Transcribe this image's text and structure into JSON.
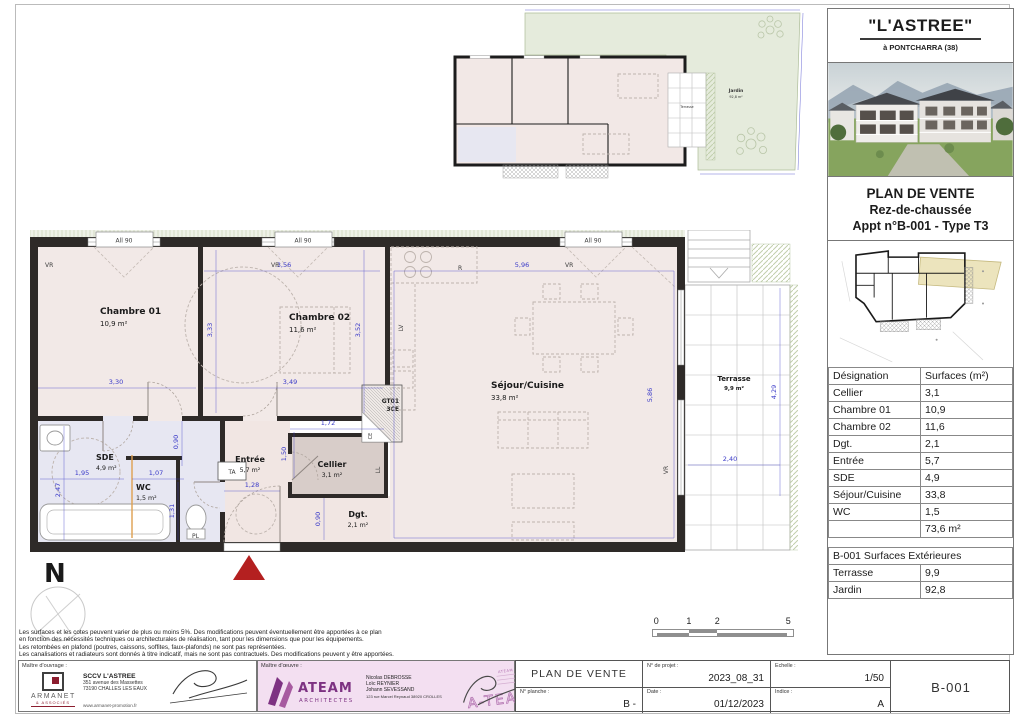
{
  "colors": {
    "dimension_blue": "#3a3ac8",
    "wall_black": "#2e2a28",
    "room_pink": "#f2e9e7",
    "wet_room_lavender": "#e7e7f2",
    "garden_green": "#e5ebdc",
    "highlight_yellow": "#ece4bd",
    "armanet_red": "#8c1d2f",
    "ateam_purple": "#7d3282",
    "entrance_triangle_red": "#b42020"
  },
  "project": {
    "name": "\"L'ASTREE\"",
    "location": "à PONTCHARRA (38)",
    "plan_type": "PLAN DE VENTE",
    "floor": "Rez-de-chaussée",
    "apartment": "Appt n°B-001 - Type T3"
  },
  "surfaces_table": {
    "headers": {
      "designation": "Désignation",
      "surface": "Surfaces (m²)"
    },
    "rows": [
      {
        "designation": "Cellier",
        "surface": "3,1"
      },
      {
        "designation": "Chambre 01",
        "surface": "10,9"
      },
      {
        "designation": "Chambre 02",
        "surface": "11,6"
      },
      {
        "designation": "Dgt.",
        "surface": "2,1"
      },
      {
        "designation": "Entrée",
        "surface": "5,7"
      },
      {
        "designation": "SDE",
        "surface": "4,9"
      },
      {
        "designation": "Séjour/Cuisine",
        "surface": "33,8"
      },
      {
        "designation": "WC",
        "surface": "1,5"
      }
    ],
    "total": "73,6 m²"
  },
  "exterior_table": {
    "title": "B-001 Surfaces Extérieures",
    "rows": [
      {
        "designation": "Terrasse",
        "surface": "9,9"
      },
      {
        "designation": "Jardin",
        "surface": "92,8"
      }
    ]
  },
  "floor_plan": {
    "rooms": {
      "chambre01": {
        "name": "Chambre 01",
        "area": "10,9 m²"
      },
      "chambre02": {
        "name": "Chambre 02",
        "area": "11,6 m²"
      },
      "sejour": {
        "name": "Séjour/Cuisine",
        "area": "33,8 m²"
      },
      "sde": {
        "name": "SDE",
        "area": "4,9 m²"
      },
      "wc": {
        "name": "WC",
        "area": "1,5 m²"
      },
      "entree": {
        "name": "Entrée",
        "area": "5,7 m²"
      },
      "cellier": {
        "name": "Cellier",
        "area": "3,1 m²"
      },
      "dgt": {
        "name": "Dgt.",
        "area": "2,1 m²"
      },
      "terrasse": {
        "name": "Terrasse",
        "area": "9,9 m²"
      }
    },
    "dimensions": {
      "ch01_width": "3,30",
      "ch02_width": "3,49",
      "ch01_height": "3,33",
      "ch02_height": "3,52",
      "ch02_top": "3,56",
      "sejour_width": "5,96",
      "sejour_height": "5,86",
      "cellier_width": "1,72",
      "cellier_height": "1,50",
      "entree_width": "1,28",
      "hall_height": "0,90",
      "sde_width": "1,95",
      "wc_top": "1,07",
      "sde_height": "2,47",
      "wc_height": "1,31",
      "dgt_height": "0,90",
      "terrasse_width": "2,40",
      "terrasse_height": "4,29"
    },
    "annotations": {
      "window": "All 90",
      "shutter": "VR",
      "fridge": "R",
      "dishwasher": "LV",
      "washer": "LL",
      "heater": "CE",
      "duct": "GT01",
      "duct2": "3CE",
      "panel": "TA",
      "closet": "PL"
    },
    "north": "N"
  },
  "overview_plan": {
    "jardin_label": "Jardin",
    "jardin_area": "92,8 m²",
    "terrasse_label": "Terrasse"
  },
  "scale_bar": {
    "ticks": [
      "0",
      "1",
      "2",
      "5"
    ]
  },
  "disclaimer": [
    "Les surfaces et les cotes peuvent varier de plus ou moins 5%. Des modifications peuvent éventuellement être apportées à ce plan",
    "en fonction des nécessités techniques ou architecturales de réalisation, tant pour les dimensions que pour les équipements.",
    "Les retombées en plafond (poutres, caissons, soffites, faux-plafonds) ne sont pas représentées.",
    "Les canalisations et radiateurs sont donnés à titre indicatif, mais ne sont pas contractuels. Des modifications peuvent y être apportées."
  ],
  "footer": {
    "client": {
      "label": "Maître d'ouvrage :",
      "logo": "ARMANET",
      "logo_sub": "& ASSOCIÉS",
      "company": "SCCV L'ASTREE",
      "address1": "351 avenue des Massettes",
      "address2": "73190 CHALLES LES EAUX",
      "website": "www.armanet-promotion.fr"
    },
    "architect": {
      "label": "Maître d'œuvre :",
      "logo": "ATEAM",
      "logo_sub": "ARCHITECTES",
      "name1": "Nicolas DEBROSSE",
      "name2": "Loïc REYNIER",
      "name3": "Johann SEVESSAND",
      "address": "123 rue Marcel Reynaud 38920 CROLLES",
      "stamp_top": "ATEAM ARCHITECTES",
      "stamp": "A-TEAM"
    },
    "titleblock": {
      "plan_title": "PLAN DE VENTE",
      "sheet_label": "N° planche :",
      "sheet_value": "B -",
      "project_label": "N° de projet :",
      "project_value": "2023_08_31",
      "scale_label": "Echelle :",
      "scale_value": "1/50",
      "date_label": "Date :",
      "date_value": "01/12/2023",
      "index_label": "Indice :",
      "index_value": "A",
      "code": "B-001"
    }
  }
}
